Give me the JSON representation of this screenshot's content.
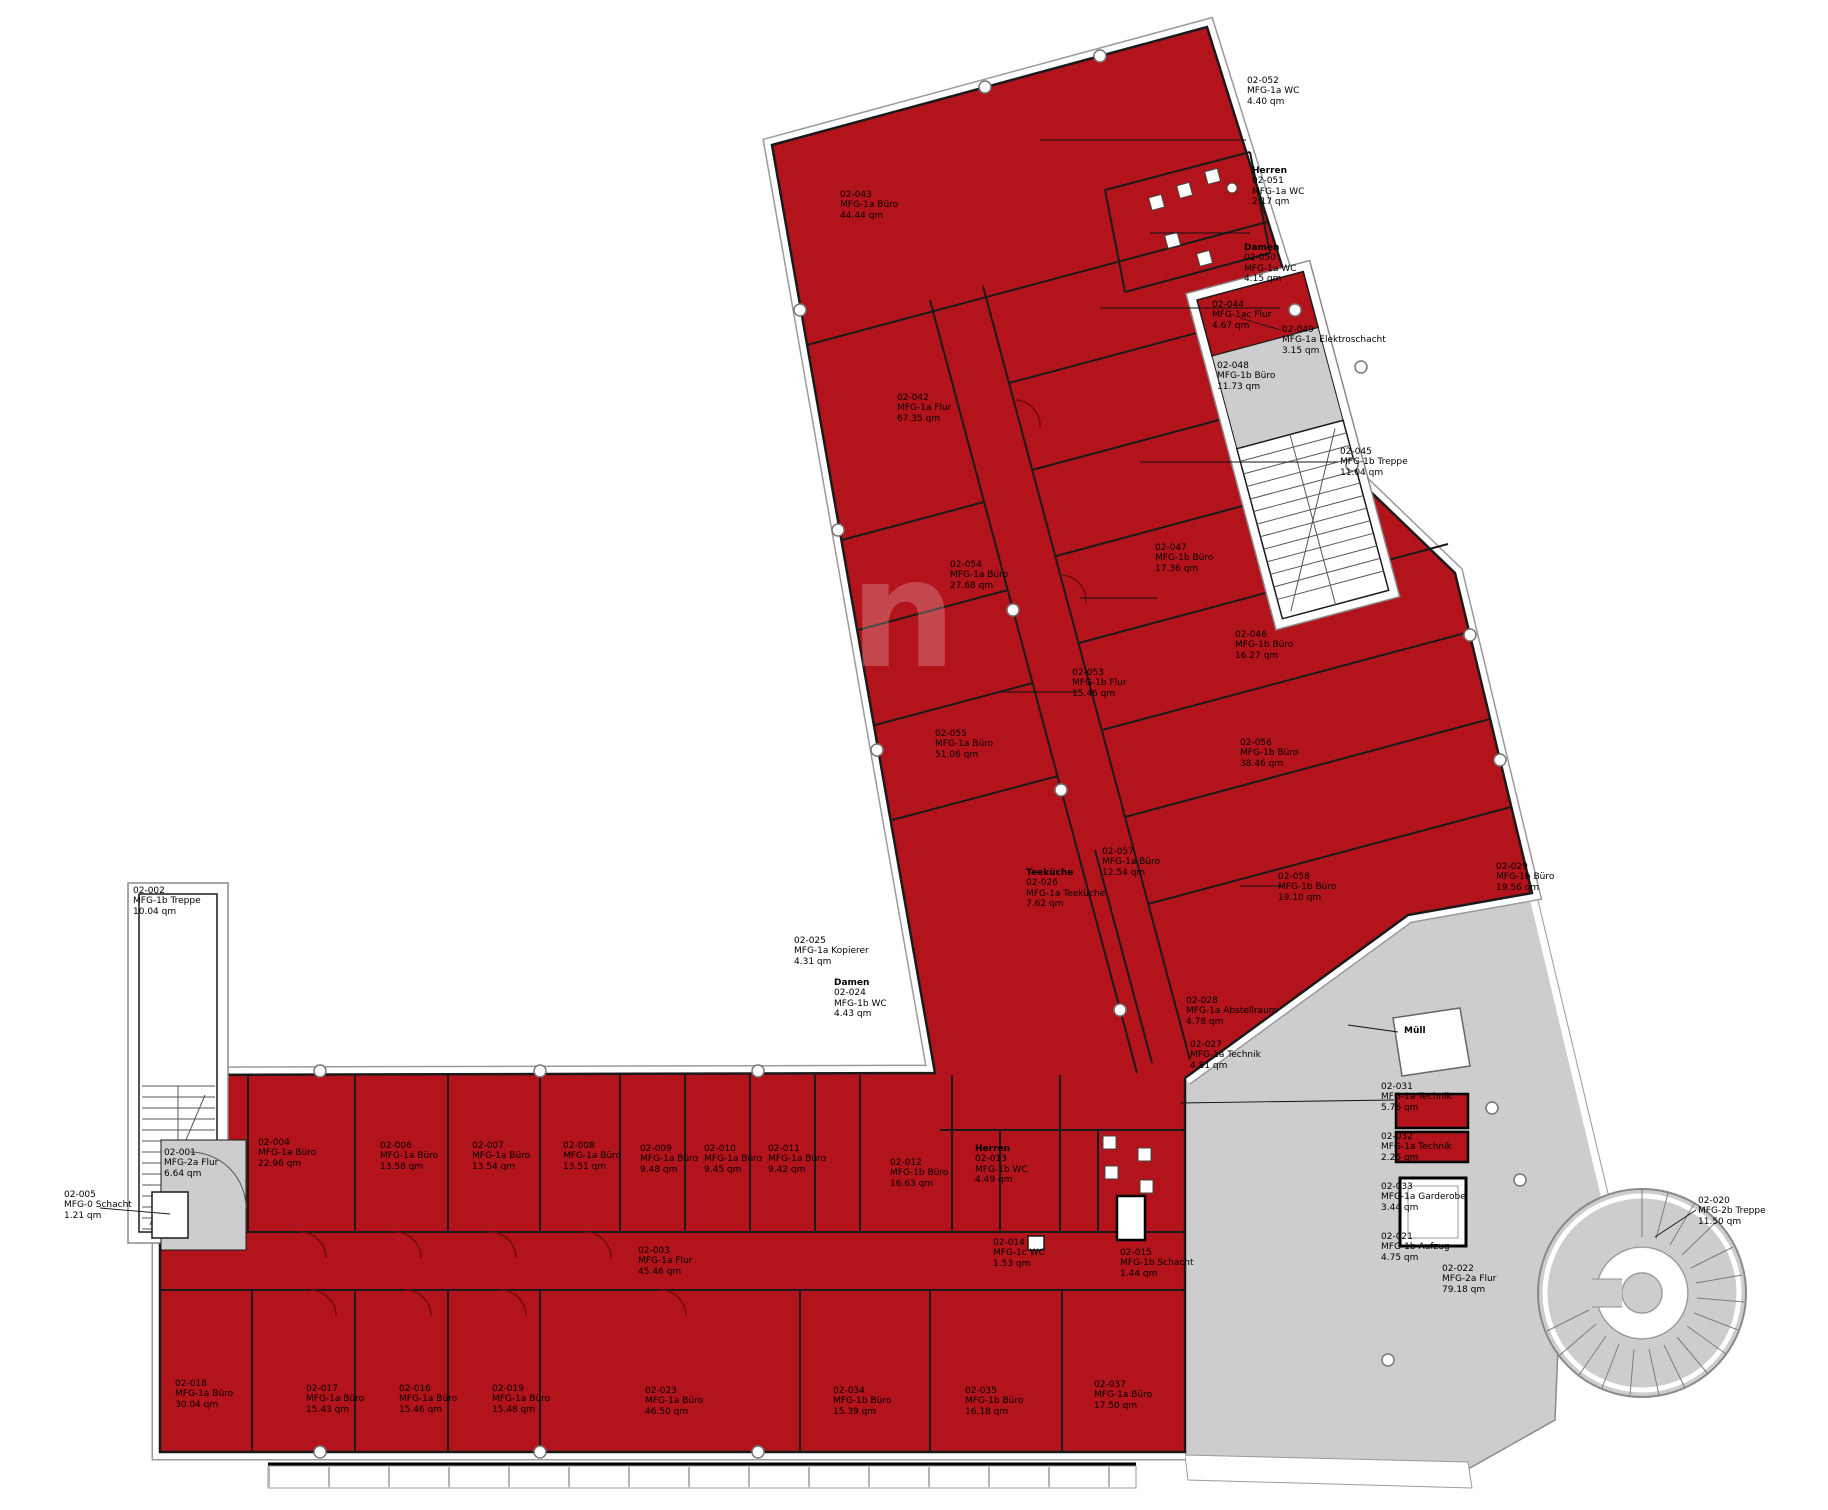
{
  "meta": {
    "drawing_type": "Grundriss 2. Obergeschoss (Mietfläche rot markiert)",
    "area_unit": "qm"
  },
  "colors": {
    "room_red": "#b3141c",
    "wall_dark": "#1a1a1a",
    "circulation_gray": "#cdcdcd",
    "facade_white": "#ffffff",
    "outline_gray": "#8a8a8a"
  },
  "watermark": "en",
  "labels": [
    {
      "num": "02-002",
      "name": "MFG-1b Treppe",
      "area": "10.04 qm"
    },
    {
      "num": "02-001",
      "name": "MFG-2a Flur",
      "area": "6.64 qm"
    },
    {
      "num": "02-005",
      "name": "MFG-0 Schacht",
      "area": "1.21 qm"
    },
    {
      "num": "02-004",
      "name": "MFG-1a Büro",
      "area": "22.96 qm"
    },
    {
      "num": "02-006",
      "name": "MFG-1a Büro",
      "area": "13.58 qm"
    },
    {
      "num": "02-007",
      "name": "MFG-1a Büro",
      "area": "13.54 qm"
    },
    {
      "num": "02-008",
      "name": "MFG-1a Büro",
      "area": "13.51 qm"
    },
    {
      "num": "02-009",
      "name": "MFG-1a Büro",
      "area": "9.48 qm"
    },
    {
      "num": "02-010",
      "name": "MFG-1a Büro",
      "area": "9.45 qm"
    },
    {
      "num": "02-011",
      "name": "MFG-1a Büro",
      "area": "9.42 qm"
    },
    {
      "num": "02-003",
      "name": "MFG-1a Flur",
      "area": "45.46 qm"
    },
    {
      "num": "02-012",
      "name": "MFG-1b Büro",
      "area": "16.63 qm"
    },
    {
      "header": "Herren",
      "num": "02-013",
      "name": "MFG-1b WC",
      "area": "4.49 qm"
    },
    {
      "num": "02-014",
      "name": "MFG-1c WC",
      "area": "1.53 qm"
    },
    {
      "num": "02-015",
      "name": "MFG-1b Schacht",
      "area": "1.44 qm"
    },
    {
      "header": "Damen",
      "num": "02-024",
      "name": "MFG-1b WC",
      "area": "4.43 qm"
    },
    {
      "num": "02-025",
      "name": "MFG-1a Kopierer",
      "area": "4.31 qm"
    },
    {
      "num": "02-018",
      "name": "MFG-1a Büro",
      "area": "30.04 qm"
    },
    {
      "num": "02-017",
      "name": "MFG-1a Büro",
      "area": "15.43 qm"
    },
    {
      "num": "02-016",
      "name": "MFG-1a Büro",
      "area": "15.46 qm"
    },
    {
      "num": "02-019",
      "name": "MFG-1a Büro",
      "area": "15.48 qm"
    },
    {
      "num": "02-023",
      "name": "MFG-1a Büro",
      "area": "46.50 qm"
    },
    {
      "num": "02-034",
      "name": "MFG-1b Büro",
      "area": "15.39 qm"
    },
    {
      "num": "02-035",
      "name": "MFG-1b Büro",
      "area": "16.18 qm"
    },
    {
      "num": "02-037",
      "name": "MFG-1a Büro",
      "area": "17.50 qm"
    },
    {
      "num": "02-022",
      "name": "MFG-2a Flur",
      "area": "79.18 qm"
    },
    {
      "num": "02-020",
      "name": "MFG-2b Treppe",
      "area": "11.50 qm"
    },
    {
      "header": "Müll"
    },
    {
      "num": "02-031",
      "name": "MFG-1a Technik",
      "area": "5.76 qm"
    },
    {
      "num": "02-032",
      "name": "MFG-1a Technik",
      "area": "2.26 qm"
    },
    {
      "num": "02-033",
      "name": "MFG-1a Garderobe",
      "area": "3.44 qm"
    },
    {
      "num": "02-021",
      "name": "MFG-1b Aufzug",
      "area": "4.75 qm"
    },
    {
      "num": "02-043",
      "name": "MFG-1a Büro",
      "area": "44.44 qm"
    },
    {
      "num": "02-042",
      "name": "MFG-1a Flur",
      "area": "67.35 qm"
    },
    {
      "num": "02-052",
      "name": "MFG-1a WC",
      "area": "4.40 qm"
    },
    {
      "header": "Herren",
      "num": "02-051",
      "name": "MFG-1a WC",
      "area": "2.17 qm"
    },
    {
      "header": "Damen",
      "num": "02-050",
      "name": "MFG-1a WC",
      "area": "4.15 qm"
    },
    {
      "num": "02-049",
      "name": "MFG-1a Elektroschacht",
      "area": "3.15 qm"
    },
    {
      "num": "02-044",
      "name": "MFG-1ac Flur",
      "area": "4.67 qm"
    },
    {
      "num": "02-045",
      "name": "MFG-1b Treppe",
      "area": "11.04 qm"
    },
    {
      "num": "02-048",
      "name": "MFG-1b Büro",
      "area": "11.73 qm"
    },
    {
      "num": "02-047",
      "name": "MFG-1b Büro",
      "area": "17.36 qm"
    },
    {
      "num": "02-046",
      "name": "MFG-1b Büro",
      "area": "16.27 qm"
    },
    {
      "num": "02-053",
      "name": "MFG-1b Flur",
      "area": "15.46 qm"
    },
    {
      "num": "02-054",
      "name": "MFG-1a Büro",
      "area": "27.68 qm"
    },
    {
      "num": "02-055",
      "name": "MFG-1a Büro",
      "area": "51.06 qm"
    },
    {
      "num": "02-056",
      "name": "MFG-1b Büro",
      "area": "38.46 qm"
    },
    {
      "num": "02-057",
      "name": "MFG-1a Büro",
      "area": "12.54 qm"
    },
    {
      "num": "02-058",
      "name": "MFG-1b Büro",
      "area": "19.10 qm"
    },
    {
      "num": "02-029",
      "name": "MFG-1b Büro",
      "area": "19.56 qm"
    },
    {
      "header": "Teeküche",
      "num": "02-026",
      "name": "MFG-1a Teeküche",
      "area": "7.62 qm"
    },
    {
      "num": "02-028",
      "name": "MFG-1a Abstellraum",
      "area": "4.78 qm"
    },
    {
      "num": "02-027",
      "name": "MFG-1a Technik",
      "area": "4.81 qm"
    }
  ]
}
